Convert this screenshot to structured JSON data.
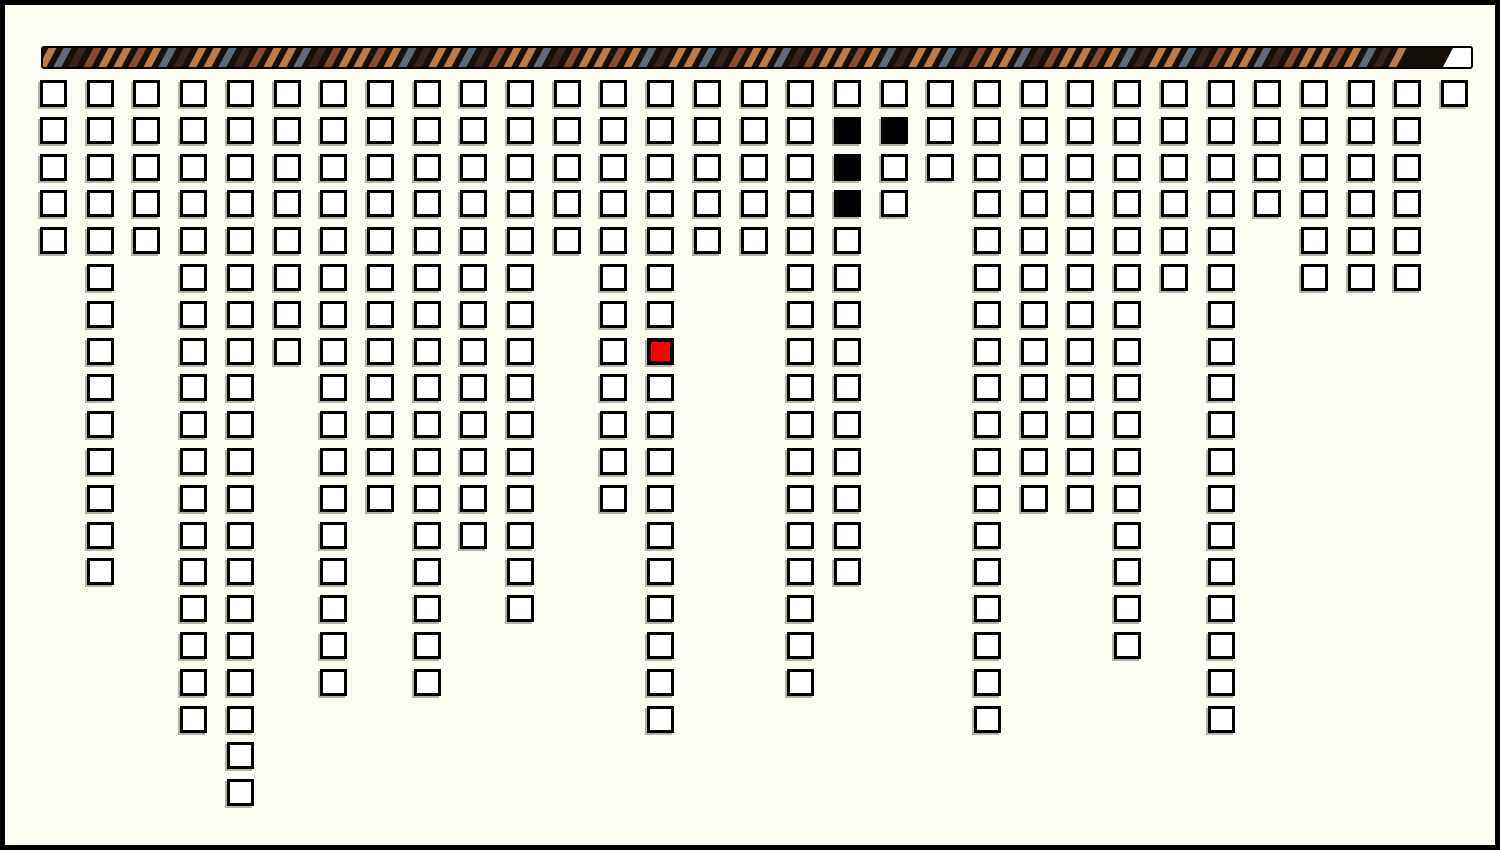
{
  "window": {
    "background_color": "#FDFCF0",
    "border_color": "#000000"
  },
  "progress_bar": {
    "description": "striped barber-pole bar, nearly full, small unfilled white segment at right end",
    "background_color": "#16100A",
    "border_color": "#000000",
    "empty_segment_color": "#FFFFFF",
    "fill_ratio": 0.98,
    "stripe_palette": {
      "tan": "#BE7B46",
      "slate": "#5D6B7A",
      "espresso": "#38231C",
      "rust": "#8A4A2F"
    },
    "stripe_pattern": [
      "tan",
      "slate",
      "espresso",
      "rust",
      "tan",
      "tan",
      "rust",
      "tan",
      "slate",
      "espresso",
      "tan",
      "tan",
      "slate",
      "espresso",
      "rust",
      "tan"
    ]
  },
  "grid": {
    "column_count": 31,
    "max_rows": 20,
    "column_heights": [
      5,
      14,
      5,
      18,
      20,
      8,
      17,
      12,
      17,
      13,
      15,
      5,
      12,
      18,
      5,
      5,
      17,
      14,
      4,
      3,
      18,
      12,
      12,
      16,
      6,
      18,
      4,
      6,
      6,
      6,
      1
    ],
    "cell_colors": {
      "default_fill": "#FFFFFF",
      "border": "#000000",
      "red": "#FF0000",
      "black": "#000000"
    },
    "special_cells": [
      {
        "column": 14,
        "row": 8,
        "color": "red"
      },
      {
        "column": 18,
        "row": 2,
        "color": "black"
      },
      {
        "column": 18,
        "row": 3,
        "color": "black"
      },
      {
        "column": 18,
        "row": 4,
        "color": "black"
      },
      {
        "column": 19,
        "row": 2,
        "color": "black"
      }
    ]
  }
}
